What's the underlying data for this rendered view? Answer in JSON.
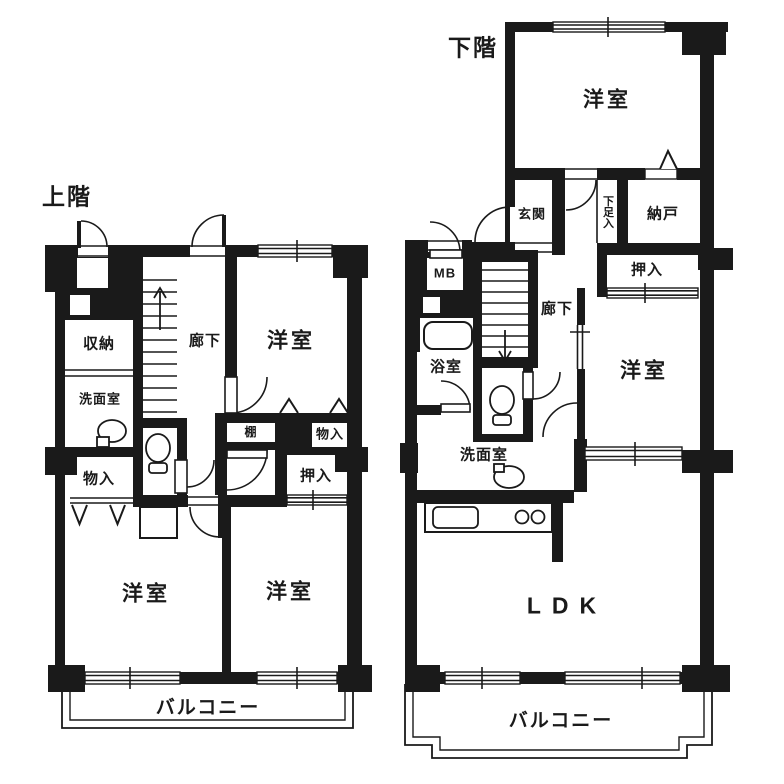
{
  "upper": {
    "floor_label": "上階",
    "rooms": {
      "storage": "収納",
      "washroom": "洗面室",
      "corridor": "廊下",
      "bedroom_top": "洋室",
      "closet_left": "物入",
      "shelf": "棚",
      "closet_right": "物入",
      "oshiire": "押入",
      "bedroom_bottom_left": "洋室",
      "bedroom_bottom_right": "洋室",
      "balcony": "バルコニー"
    }
  },
  "lower": {
    "floor_label": "下階",
    "rooms": {
      "bedroom_top": "洋室",
      "entrance": "玄関",
      "shoe_cabinet": "下足入",
      "storeroom": "納戸",
      "meter_box": "MB",
      "oshiire": "押入",
      "corridor": "廊下",
      "bathroom": "浴室",
      "bedroom_middle": "洋室",
      "washroom": "洗面室",
      "ldk": "LDK",
      "balcony": "バルコニー"
    }
  },
  "colors": {
    "ink": "#1a1a1a",
    "background": "#ffffff"
  }
}
